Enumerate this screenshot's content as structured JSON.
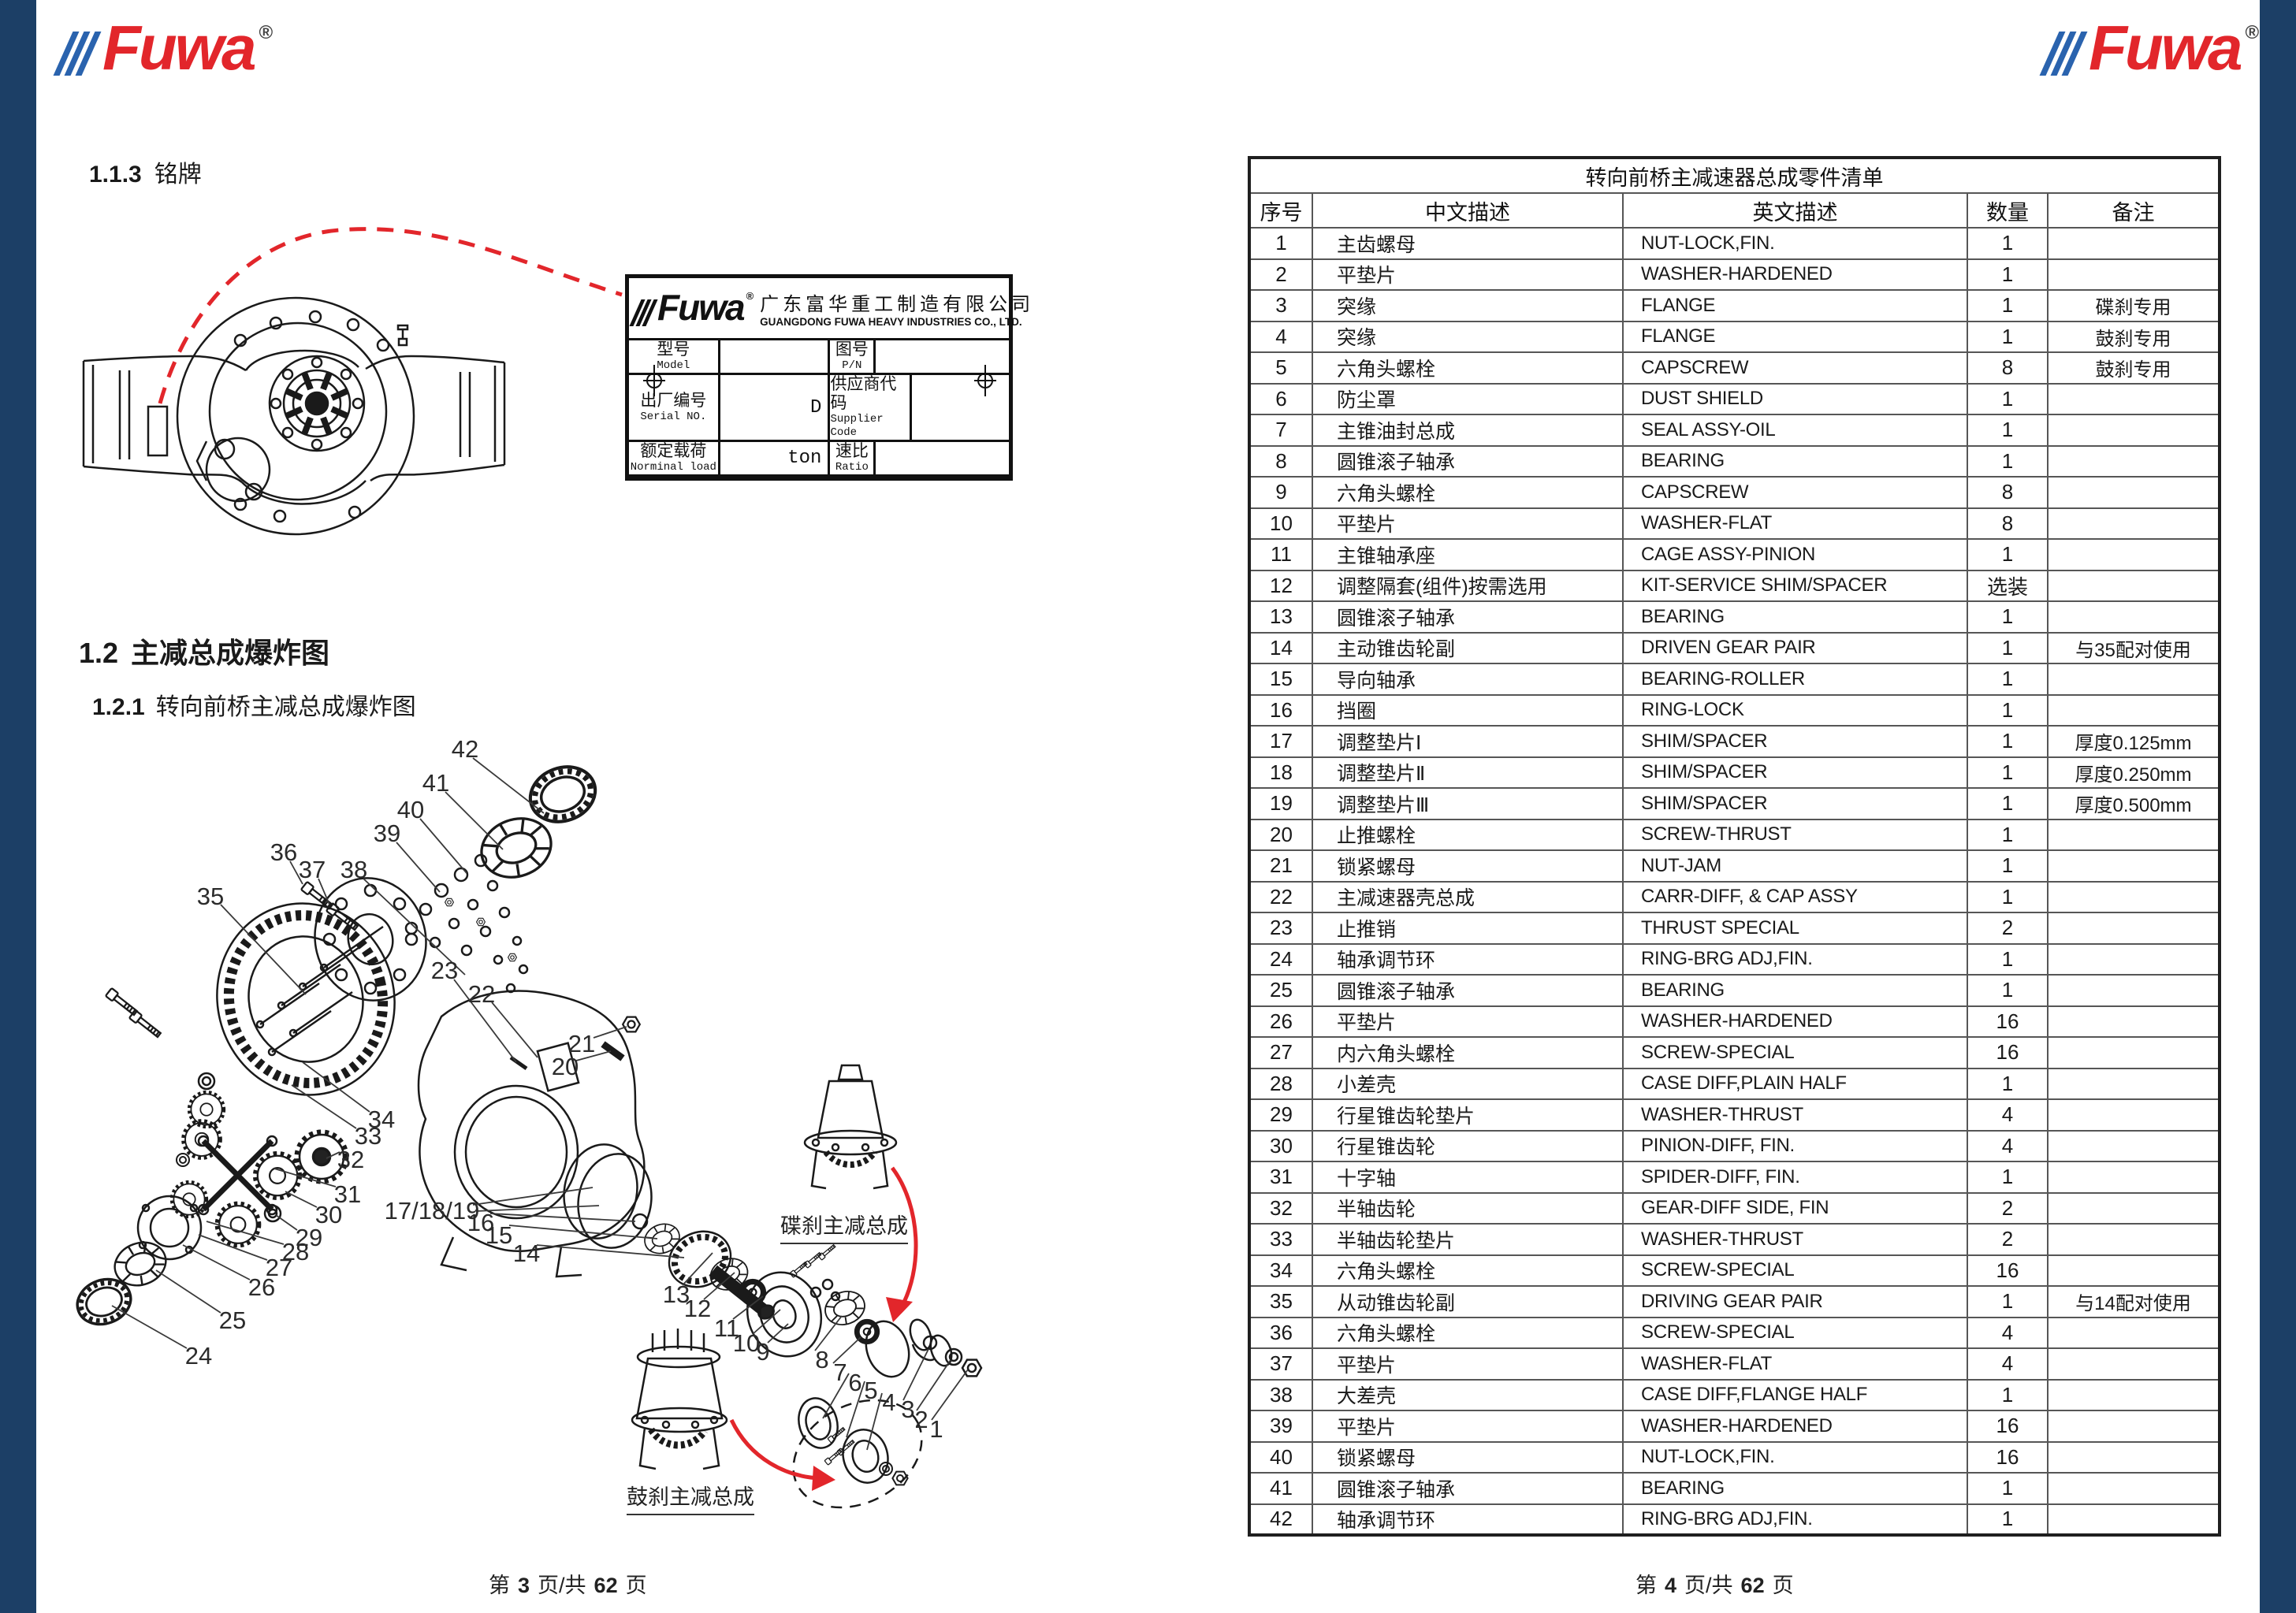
{
  "brand": {
    "name": "Fuwa",
    "reg": "®"
  },
  "colors": {
    "accent_red": "#e2262b",
    "navy_bar": "#1c3f66",
    "stripe_blue": "#2a63ae"
  },
  "page_left": {
    "sections": {
      "s113_num": "1.1.3",
      "s113_title": "铭牌",
      "s12_num": "1.2",
      "s12_title": "主减总成爆炸图",
      "s121_num": "1.2.1",
      "s121_title": "转向前桥主减总成爆炸图"
    },
    "nameplate": {
      "company_cn": "广东富华重工制造有限公司",
      "company_en": "GUANGDONG FUWA HEAVY INDUSTRIES CO., LTD.",
      "rows": [
        {
          "l1": "型号",
          "l1en": "Model",
          "v1": "",
          "l2": "图号",
          "l2en": "P/N",
          "v2": ""
        },
        {
          "l1": "出厂编号",
          "l1en": "Serial NO.",
          "v1": "D",
          "l2": "供应商代码",
          "l2en": "Supplier Code",
          "v2": ""
        },
        {
          "l1": "额定载荷",
          "l1en": "Norminal load",
          "v1": "ton",
          "l2": "速比",
          "l2en": "Ratio",
          "v2": ""
        }
      ]
    },
    "diagram": {
      "callout_disc": "碟刹主减总成",
      "callout_drum": "鼓刹主减总成",
      "part_labels": [
        "42",
        "41",
        "40",
        "39",
        "36",
        "37",
        "38",
        "35",
        "23",
        "22",
        "21",
        "20",
        "34",
        "33",
        "32",
        "31",
        "30",
        "29",
        "28",
        "27",
        "26",
        "25",
        "24",
        "17/18/19",
        "16",
        "15",
        "14",
        "13",
        "12",
        "11",
        "10",
        "9",
        "8",
        "7",
        "6",
        "5",
        "4",
        "3",
        "2",
        "1"
      ]
    },
    "footer": {
      "pre": "第",
      "num": "3",
      "mid": "页/共",
      "total": "62",
      "post": "页"
    }
  },
  "page_right": {
    "table": {
      "title": "转向前桥主减速器总成零件清单",
      "headers": [
        "序号",
        "中文描述",
        "英文描述",
        "数量",
        "备注"
      ],
      "rows": [
        [
          "1",
          "主齿螺母",
          "NUT-LOCK,FIN.",
          "1",
          ""
        ],
        [
          "2",
          "平垫片",
          "WASHER-HARDENED",
          "1",
          ""
        ],
        [
          "3",
          "突缘",
          "FLANGE",
          "1",
          "碟刹专用"
        ],
        [
          "4",
          "突缘",
          "FLANGE",
          "1",
          "鼓刹专用"
        ],
        [
          "5",
          "六角头螺栓",
          "CAPSCREW",
          "8",
          "鼓刹专用"
        ],
        [
          "6",
          "防尘罩",
          "DUST SHIELD",
          "1",
          ""
        ],
        [
          "7",
          "主锥油封总成",
          "SEAL ASSY-OIL",
          "1",
          ""
        ],
        [
          "8",
          "圆锥滚子轴承",
          "BEARING",
          "1",
          ""
        ],
        [
          "9",
          "六角头螺栓",
          "CAPSCREW",
          "8",
          ""
        ],
        [
          "10",
          "平垫片",
          "WASHER-FLAT",
          "8",
          ""
        ],
        [
          "11",
          "主锥轴承座",
          "CAGE ASSY-PINION",
          "1",
          ""
        ],
        [
          "12",
          "调整隔套(组件)按需选用",
          "KIT-SERVICE SHIM/SPACER",
          "选装",
          ""
        ],
        [
          "13",
          "圆锥滚子轴承",
          "BEARING",
          "1",
          ""
        ],
        [
          "14",
          "主动锥齿轮副",
          "DRIVEN GEAR PAIR",
          "1",
          "与35配对使用"
        ],
        [
          "15",
          "导向轴承",
          "BEARING-ROLLER",
          "1",
          ""
        ],
        [
          "16",
          "挡圈",
          "RING-LOCK",
          "1",
          ""
        ],
        [
          "17",
          "调整垫片Ⅰ",
          "SHIM/SPACER",
          "1",
          "厚度0.125mm"
        ],
        [
          "18",
          "调整垫片Ⅱ",
          "SHIM/SPACER",
          "1",
          "厚度0.250mm"
        ],
        [
          "19",
          "调整垫片Ⅲ",
          "SHIM/SPACER",
          "1",
          "厚度0.500mm"
        ],
        [
          "20",
          "止推螺栓",
          "SCREW-THRUST",
          "1",
          ""
        ],
        [
          "21",
          "锁紧螺母",
          "NUT-JAM",
          "1",
          ""
        ],
        [
          "22",
          "主减速器壳总成",
          "CARR-DIFF, & CAP ASSY",
          "1",
          ""
        ],
        [
          "23",
          "止推销",
          "THRUST SPECIAL",
          "2",
          ""
        ],
        [
          "24",
          "轴承调节环",
          "RING-BRG ADJ,FIN.",
          "1",
          ""
        ],
        [
          "25",
          "圆锥滚子轴承",
          "BEARING",
          "1",
          ""
        ],
        [
          "26",
          "平垫片",
          "WASHER-HARDENED",
          "16",
          ""
        ],
        [
          "27",
          "内六角头螺栓",
          "SCREW-SPECIAL",
          "16",
          ""
        ],
        [
          "28",
          "小差壳",
          "CASE DIFF,PLAIN HALF",
          "1",
          ""
        ],
        [
          "29",
          "行星锥齿轮垫片",
          "WASHER-THRUST",
          "4",
          ""
        ],
        [
          "30",
          "行星锥齿轮",
          "PINION-DIFF, FIN.",
          "4",
          ""
        ],
        [
          "31",
          "十字轴",
          "SPIDER-DIFF, FIN.",
          "1",
          ""
        ],
        [
          "32",
          "半轴齿轮",
          "GEAR-DIFF SIDE, FIN",
          "2",
          ""
        ],
        [
          "33",
          "半轴齿轮垫片",
          "WASHER-THRUST",
          "2",
          ""
        ],
        [
          "34",
          "六角头螺栓",
          "SCREW-SPECIAL",
          "16",
          ""
        ],
        [
          "35",
          "从动锥齿轮副",
          "DRIVING GEAR PAIR",
          "1",
          "与14配对使用"
        ],
        [
          "36",
          "六角头螺栓",
          "SCREW-SPECIAL",
          "4",
          ""
        ],
        [
          "37",
          "平垫片",
          "WASHER-FLAT",
          "4",
          ""
        ],
        [
          "38",
          "大差壳",
          "CASE DIFF,FLANGE HALF",
          "1",
          ""
        ],
        [
          "39",
          "平垫片",
          "WASHER-HARDENED",
          "16",
          ""
        ],
        [
          "40",
          "锁紧螺母",
          "NUT-LOCK,FIN.",
          "16",
          ""
        ],
        [
          "41",
          "圆锥滚子轴承",
          "BEARING",
          "1",
          ""
        ],
        [
          "42",
          "轴承调节环",
          "RING-BRG ADJ,FIN.",
          "1",
          ""
        ]
      ]
    },
    "footer": {
      "pre": "第",
      "num": "4",
      "mid": "页/共",
      "total": "62",
      "post": "页"
    }
  }
}
